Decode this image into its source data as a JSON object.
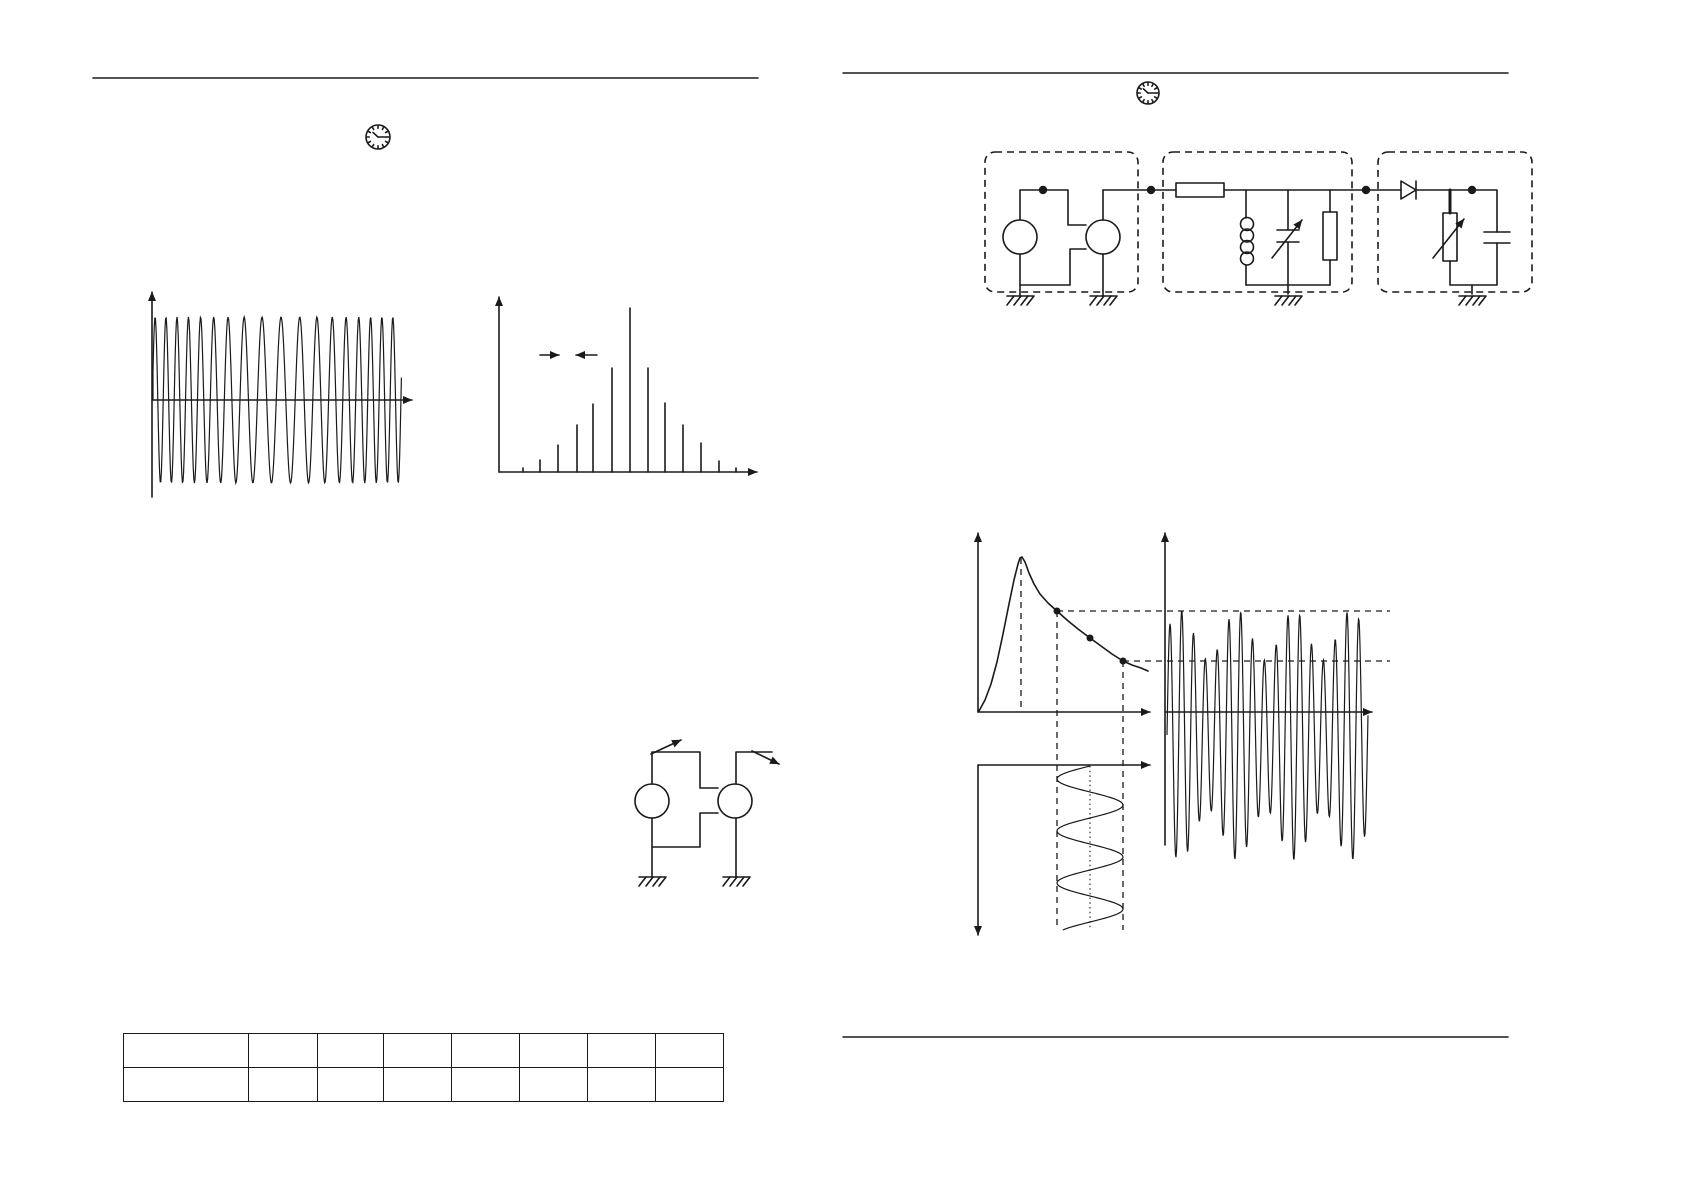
{
  "canvas": {
    "width": 1684,
    "height": 1190,
    "background": "#ffffff",
    "ink_color": "#1a1a1a"
  },
  "icons": {
    "left_page_clock": {
      "name": "clock-icon",
      "x": 378,
      "y": 137,
      "r": 12
    },
    "right_page_clock": {
      "name": "clock-icon",
      "x": 1148,
      "y": 93,
      "r": 11
    }
  },
  "rules": {
    "left_top": {
      "x1": 93,
      "x2": 758,
      "y": 78
    },
    "right_top": {
      "x1": 843,
      "x2": 1508,
      "y": 73
    },
    "right_bottom": {
      "x1": 843,
      "x2": 1508,
      "y": 1037
    }
  },
  "table": {
    "x": 123,
    "y": 1033,
    "row_height": 33,
    "col_widths": [
      125,
      69,
      66,
      68,
      68,
      68,
      68,
      68
    ],
    "rows": [
      [
        "",
        "",
        "",
        "",
        "",
        "",
        "",
        ""
      ],
      [
        "",
        "",
        "",
        "",
        "",
        "",
        "",
        ""
      ]
    ]
  },
  "chart_data": [
    {
      "id": "fm_time_signal",
      "type": "line",
      "description": "Constant-amplitude carrier whose frequency varies periodically (FM signal, time domain)",
      "axes": {
        "origin_x": 152,
        "origin_y": 400,
        "x_end": 412,
        "y_top": 292,
        "y_bottom": 497
      },
      "wave": {
        "x_start": 153,
        "x_end": 402,
        "amplitude": 83,
        "carrier_period_px": 13.8,
        "freq_mod_depth": 0.28,
        "mod_period_px": 249
      }
    },
    {
      "id": "fm_line_spectrum",
      "type": "bar",
      "description": "Symmetric FM line spectrum (Bessel sideband amplitudes) around the carrier",
      "axes": {
        "origin_x": 499,
        "baseline_y": 472,
        "x_end": 757,
        "y_top": 297
      },
      "stems": [
        {
          "x": 523,
          "h": 4,
          "thick": false
        },
        {
          "x": 540,
          "h": 12,
          "thick": false
        },
        {
          "x": 558,
          "h": 27,
          "thick": false
        },
        {
          "x": 577,
          "h": 47,
          "thick": false
        },
        {
          "x": 593,
          "h": 68,
          "thick": true
        },
        {
          "x": 612,
          "h": 104,
          "thick": false
        },
        {
          "x": 630,
          "h": 164,
          "thick": false
        },
        {
          "x": 648,
          "h": 104,
          "thick": false
        },
        {
          "x": 665,
          "h": 69,
          "thick": false
        },
        {
          "x": 683,
          "h": 47,
          "thick": false
        },
        {
          "x": 701,
          "h": 29,
          "thick": false
        },
        {
          "x": 719,
          "h": 11,
          "thick": true
        },
        {
          "x": 736,
          "h": 4,
          "thick": false
        }
      ],
      "spacing_marker": {
        "y": 355,
        "left_x": 540,
        "right_x": 597,
        "gap_left": 559,
        "gap_right": 576
      }
    },
    {
      "id": "slope_detection",
      "type": "line",
      "description": "Resonance curve with operating points; FM input sine (vertical time axis) mapped to amplitude-modulated output wave",
      "resonance_axes": {
        "vx": 978,
        "v_top": 533,
        "h_y": 712,
        "h_end": 1150
      },
      "curve_points": [
        [
          979,
          711
        ],
        [
          985,
          700
        ],
        [
          991,
          684
        ],
        [
          997,
          662
        ],
        [
          1003,
          634
        ],
        [
          1009,
          604
        ],
        [
          1014,
          580
        ],
        [
          1018,
          564
        ],
        [
          1020,
          558
        ],
        [
          1022,
          557
        ],
        [
          1025,
          562
        ],
        [
          1029,
          573
        ],
        [
          1034,
          584
        ],
        [
          1040,
          594
        ],
        [
          1048,
          603
        ],
        [
          1057,
          611
        ],
        [
          1067,
          620
        ],
        [
          1078,
          629
        ],
        [
          1090,
          638
        ],
        [
          1101,
          646
        ],
        [
          1112,
          654
        ],
        [
          1123,
          661
        ],
        [
          1132,
          665
        ],
        [
          1141,
          668
        ],
        [
          1148,
          671
        ]
      ],
      "marked_points": [
        [
          1057,
          611
        ],
        [
          1090,
          638
        ],
        [
          1123,
          661
        ]
      ],
      "peak": {
        "x": 1021,
        "y": 558
      },
      "guides": {
        "dashed_verticals": [
          [
            1021,
            558,
            711
          ],
          [
            1057,
            611,
            930
          ],
          [
            1123,
            661,
            930
          ]
        ],
        "dashed_horizontals": [
          [
            611,
            1057,
            1390
          ],
          [
            661,
            1123,
            1390
          ]
        ],
        "dotted_vertical": [
          1090,
          766,
          930
        ]
      },
      "output_axes": {
        "vx": 1165,
        "v_top": 533,
        "v_bottom": 845,
        "h_y": 712,
        "h_end": 1372
      },
      "input_axes": {
        "vx": 978,
        "v_top": 765,
        "v_bottom": 935,
        "h_y": 765,
        "h_end": 1150
      },
      "input_sine": {
        "center_x": 1090,
        "amplitude": 33,
        "y_start": 766,
        "y_end": 930,
        "period_px": 52
      },
      "output_wave": {
        "x_start": 1167,
        "x_end": 1368,
        "mid_y": 735,
        "amp_base": 100,
        "amp_mod": 25,
        "carrier_period_px": 11.8,
        "envelope_period_px": 57,
        "envelope_max_x": 1180
      }
    }
  ]
}
